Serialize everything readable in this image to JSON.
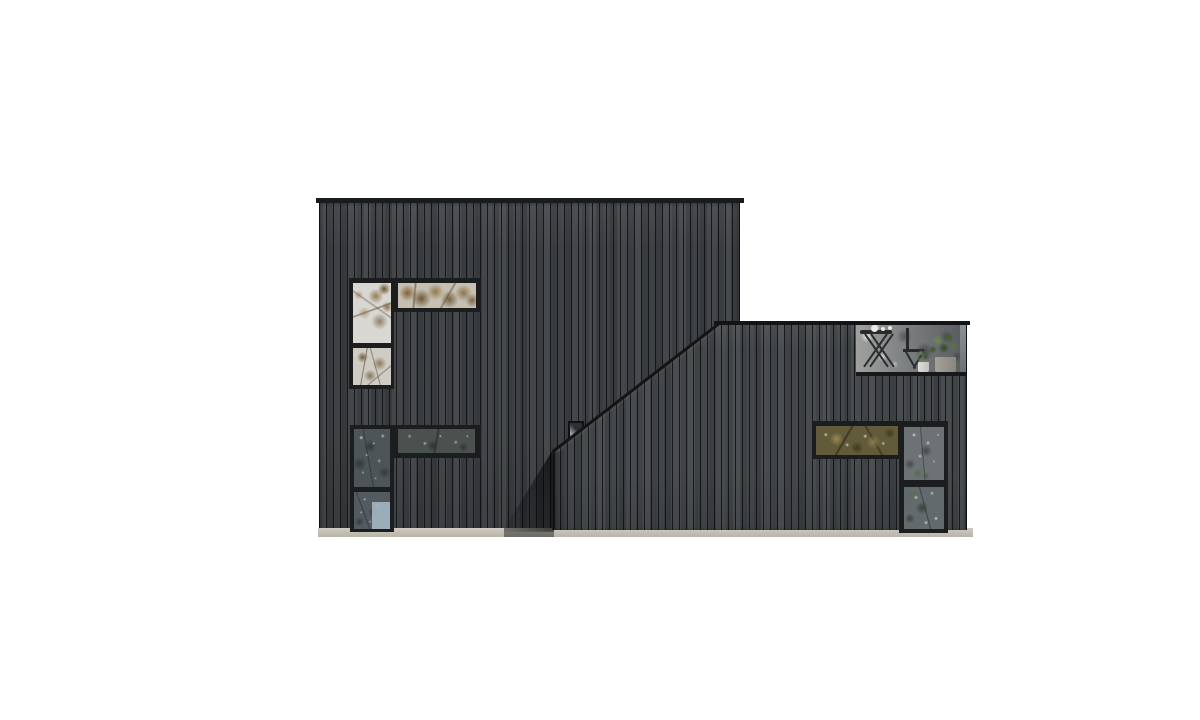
{
  "scene": {
    "label": "Side elevation rendering of a black vertical-timber house: a tall flat-roofed main volume and a lower front wing with a parapet sloping up to the right, corner window groups reflecting autumn trees, a small square window, a recessed roof terrace with bistro furniture and potted plants, on a light foundation strip against a white background",
    "background_color": "#ffffff",
    "palette": {
      "siding_main": "#3c3f42",
      "siding_wing": "#414548",
      "board_gap": "#202225",
      "roof_cap": "#1a1b1d",
      "window_frame": "#1b1d1f",
      "foundation": "#c9c5ba",
      "cast_shadow": "#0a0c0e",
      "sky_reflection": "#d8d7d1",
      "autumn_leaf_reflection": "#8a6a38",
      "winter_tree_reflection": "#4e5559",
      "olive_leaf_reflection": "#a89158",
      "blue_sky_patch": "#a3b6c2",
      "plant_green": "#5c7540",
      "pot_concrete": "#9a968c",
      "pot_white": "#dcdad5",
      "terrace_furniture": "#282a2c",
      "terrace_glass": "#85898b"
    },
    "volumes": [
      {
        "name": "main-block",
        "kind": "two-storey flat-roofed volume, vertical board cladding"
      },
      {
        "name": "side-wing",
        "kind": "lower front wing, parapet slopes up left-to-right then flat"
      }
    ],
    "windows": [
      {
        "name": "upper-left-corner-window-group",
        "shape": "L (tall two-pane + high horizontal band)",
        "reflection": "white sky with autumn leaves"
      },
      {
        "name": "lower-left-corner-window-group",
        "shape": "L (full-height two-pane + horizontal band)",
        "reflection": "dark bare trees with blue sky patch"
      },
      {
        "name": "small-square-window",
        "reflection": "dark with light corner"
      },
      {
        "name": "wing-horizontal-window",
        "reflection": "olive-gold autumn canopy"
      },
      {
        "name": "wing-vertical-window",
        "shape": "two-pane",
        "reflection": "grey trees with green foliage"
      }
    ],
    "terrace": {
      "name": "roof-terrace",
      "features": [
        "glass balustrade",
        "folding bistro table",
        "folding chair",
        "small white pot plant",
        "large concrete pot plant",
        "table items"
      ]
    }
  }
}
